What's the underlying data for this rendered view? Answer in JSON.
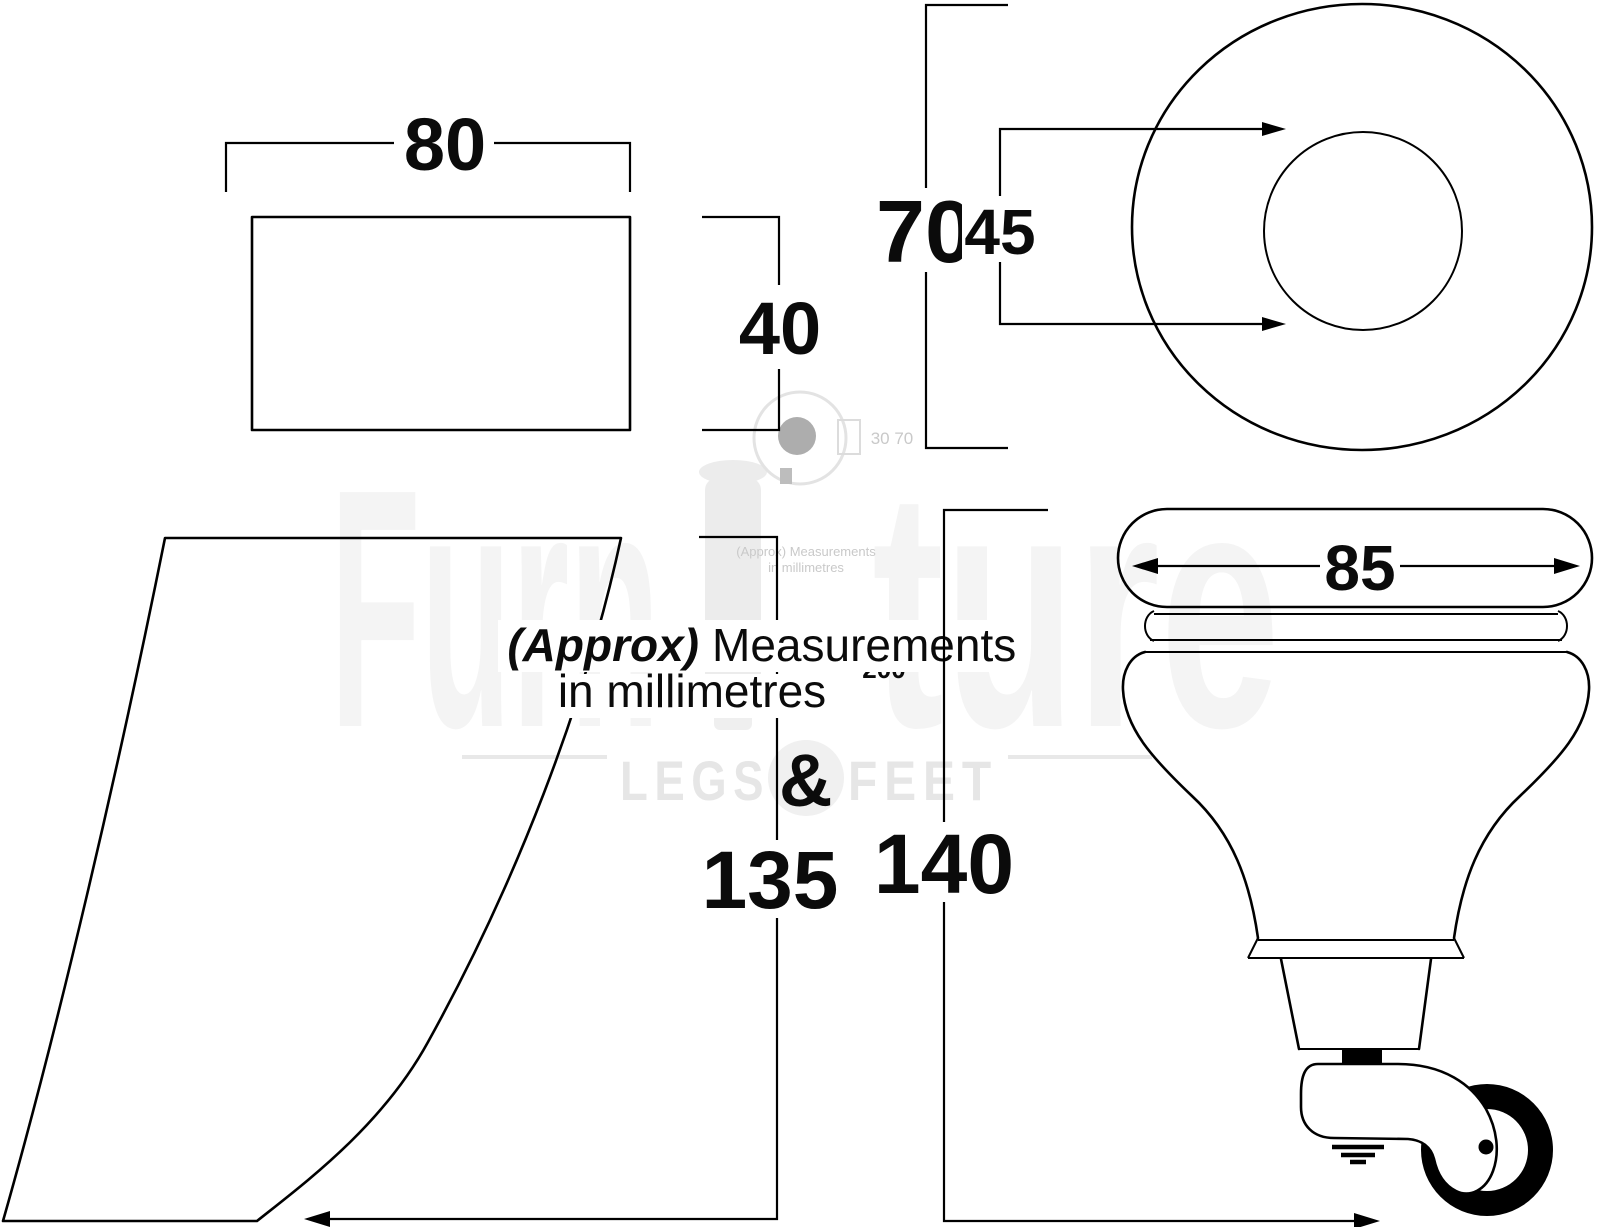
{
  "meta": {
    "description": "Technical dimension drawing of sofa furniture legs with castor",
    "units_note_bold": "(Approx)",
    "units_note_rest": "Measurements",
    "units_note_line2": "in millimetres"
  },
  "dimensions": {
    "rect_top_width": "80",
    "rect_top_height": "40",
    "round_top_outer_diameter": "70",
    "round_top_inner_diameter": "45",
    "wedge_leg_height": "135",
    "castor_leg_height": "140",
    "castor_leg_cap_width": "85"
  },
  "watermark": {
    "brand_left": "Furn",
    "brand_right": "ture",
    "legs": "LEGS",
    "ampersand": "&",
    "feet": "FEET",
    "small_note_1": "(Approx) Measurements",
    "small_note_2": "in millimetres",
    "size_200": "200",
    "size_30_70": "30 70"
  },
  "colors": {
    "line": "#000000",
    "text": "#0b0b0b",
    "background": "#ffffff",
    "watermark_light": "#f4f4f4",
    "watermark_mid": "#e6e6e6"
  }
}
